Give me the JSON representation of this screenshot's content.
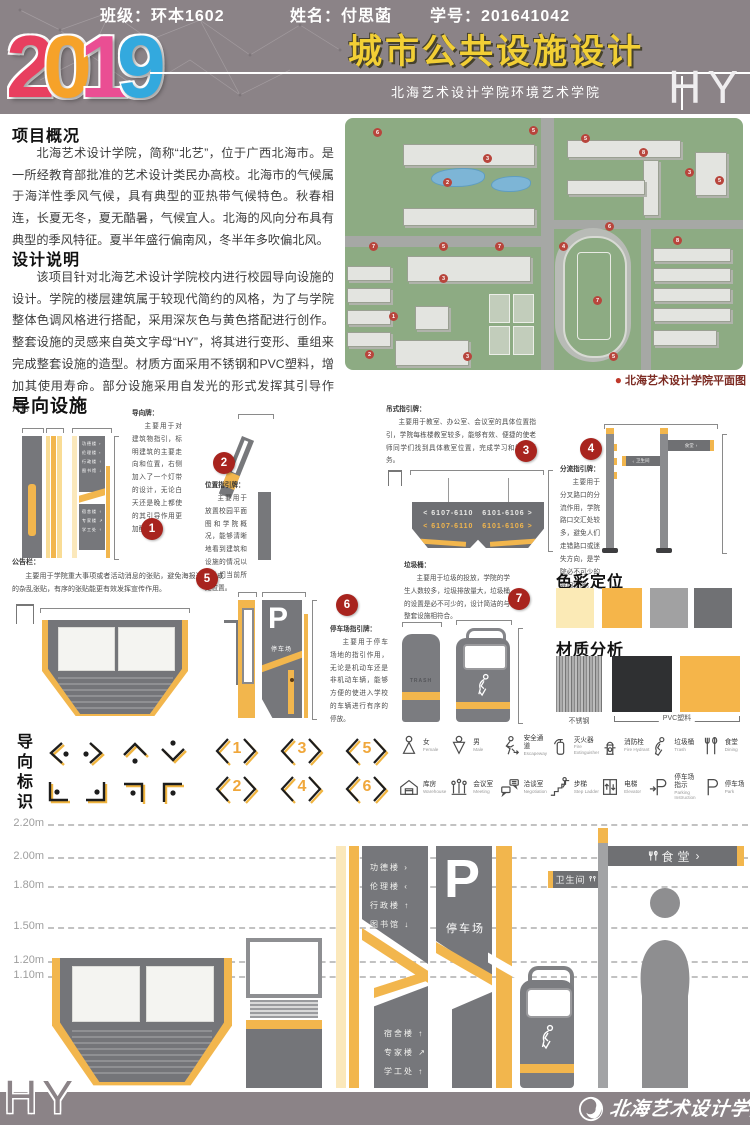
{
  "header": {
    "year_digits": [
      "2",
      "0",
      "1",
      "9"
    ],
    "title": "城市公共设施设计",
    "subtitle": "北海艺术设计学院环境艺术学院",
    "logo": "HY"
  },
  "overview": {
    "heading": "项目概况",
    "body": "北海艺术设计学院，简称“北艺”，位于广西北海市。是一所经教育部批准的艺术设计类民办高校。北海市的气候属于海洋性季风气候，具有典型的亚热带气候特色。秋春相连，长夏无冬，夏无酷暑，气候宜人。北海的风向分布具有典型的季风特征。夏半年盛行偏南风，冬半年多吹偏北风。"
  },
  "design": {
    "heading": "设计说明",
    "body": "该项目针对北海艺术设计学院校内进行校园导向设施的设计。学院的楼层建筑属于较现代简约的风格，为了与学院整体色调风格进行搭配，采用深灰色与黄色搭配进行创作。整套设施的灵感来自英文字母“HY”，将其进行变形、重组来完成整套设施的造型。材质方面采用不锈钢和PVC塑料，增加其使用寿命。部分设施采用自发光的形式发挥其引导作用。"
  },
  "map": {
    "caption": "北海艺术设计学院平面图",
    "markers": [
      "6",
      "3",
      "5",
      "5",
      "8",
      "3",
      "5",
      "2",
      "7",
      "5",
      "7",
      "4",
      "6",
      "8",
      "3",
      "1",
      "2",
      "3",
      "7",
      "5"
    ]
  },
  "fac": {
    "heading": "导向设施",
    "items": [
      {
        "num": "1",
        "title": "导向牌：",
        "body": "主要用于对建筑物指引，标明建筑的主要走向和位置，右侧加入了一个灯带的设计，无论白天还是晚上都使的其引导作用更加醒目。"
      },
      {
        "num": "2",
        "title": "位置指引牌：",
        "body": "主要用于放置校园平面图和学院概况，能够清晰地看到建筑和设施的情况以及人们当前所处位置。"
      },
      {
        "num": "3",
        "title": "吊式指引牌：",
        "body": "主要用于教室、办公室、会议室的具体位置指引，学院每栋楼教室较多，能够有效、便捷的使老师同学们找到具体教室位置，完成学习和教学任务。"
      },
      {
        "num": "4",
        "title": "分流指引牌：",
        "body": "主要用于分叉路口的分流作用，学院路口交汇处较多，避免人们走错路口或迷失方向，是学院必不可少的导向设施。"
      },
      {
        "num": "5",
        "title": "公告栏：",
        "body": "主要用于学院重大事项或者活动消息的张贴，避免海报过多造成的杂乱张贴，有序的张贴能更有效发挥宣传作用。"
      },
      {
        "num": "6",
        "title": "停车场指引牌：",
        "body": "主要用于停车场地的指引作用，无论是机动车还是非机动车辆，能够方便的使进入学校的车辆进行有序的停放。"
      },
      {
        "num": "7",
        "title": "垃圾桶：",
        "body": "主要用于垃圾的投放，学院的学生人数较多，垃圾排放量大，垃圾桶的设置是必不可少的，设计简洁的与整套设施相符合。"
      }
    ],
    "sign_rows": {
      "left": "< 6107-6110",
      "right": "6101-6106 >"
    },
    "buildings_top": [
      "功德楼 ›",
      "伦理楼 ‹",
      "行政楼 ↑",
      "图书馆 ↓"
    ],
    "buildings_bottom": [
      "宿舍楼 ↑",
      "专家楼 ↗",
      "学工处 ↑"
    ],
    "parking": {
      "letter": "P",
      "label": "停车场"
    },
    "trash_label": "TRASH"
  },
  "colors": {
    "heading": "色彩定位",
    "swatches": [
      "#fbeab6",
      "#f5b54a",
      "#a1a1a2",
      "#707174"
    ]
  },
  "materials": {
    "heading": "材质分析",
    "steel_label": "不锈钢",
    "pvc_label": "PVC塑料"
  },
  "signage": {
    "heading": "导向标识",
    "numbers": [
      "1",
      "3",
      "5",
      "2",
      "4",
      "6"
    ]
  },
  "icons": [
    {
      "zh": "女",
      "en": "Female"
    },
    {
      "zh": "男",
      "en": "Male"
    },
    {
      "zh": "安全通道",
      "en": "Escapeway"
    },
    {
      "zh": "灭火器",
      "en": "Fire Extinguisher"
    },
    {
      "zh": "消防栓",
      "en": "Fire Hydrant"
    },
    {
      "zh": "垃圾桶",
      "en": "Trash"
    },
    {
      "zh": "食堂",
      "en": "Dining"
    },
    {
      "zh": "库房",
      "en": "Warehouse"
    },
    {
      "zh": "会议室",
      "en": "Meeting"
    },
    {
      "zh": "洽谈室",
      "en": "Negotiation"
    },
    {
      "zh": "步梯",
      "en": "Step Ladder"
    },
    {
      "zh": "电梯",
      "en": "Elevator"
    },
    {
      "zh": "停车场指示",
      "en": "Parking Instruction"
    },
    {
      "zh": "停车场",
      "en": "Park"
    }
  ],
  "heights": [
    "2.20m",
    "2.00m",
    "1.80m",
    "1.50m",
    "1.20m",
    "1.10m"
  ],
  "pole": {
    "canteen": "食堂",
    "toilet": "卫生间",
    "left_arrow": "‹",
    "right_arrow": "›"
  },
  "footer": {
    "logo": "HY",
    "class_label": "班级：环本1602",
    "name_label": "姓名：付思菡",
    "id_label": "学号：201641042",
    "school": "北海艺术设计学院"
  }
}
